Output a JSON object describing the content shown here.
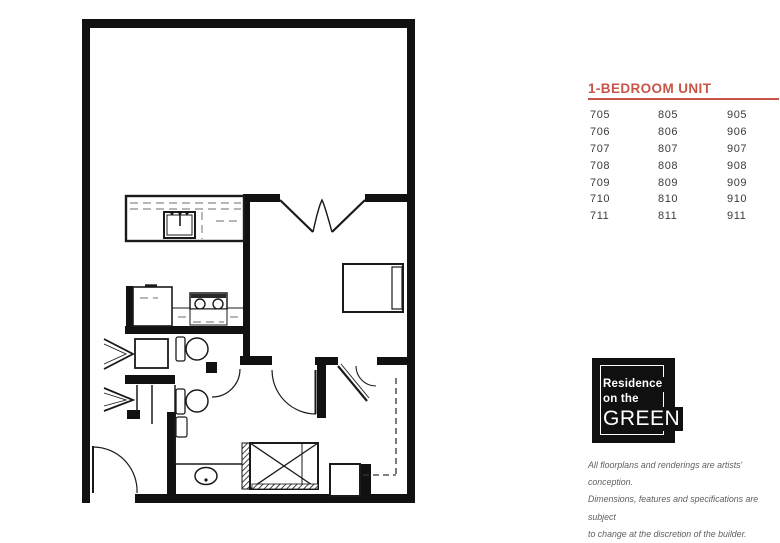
{
  "colors": {
    "accent_red": "#c75547",
    "text_dark": "#3b3b3c",
    "logo_bg": "#101010",
    "plan_line": "#1a1a1a"
  },
  "unit_list": {
    "title": "1-BEDROOM UNIT",
    "rows": [
      [
        "705",
        "805",
        "905"
      ],
      [
        "706",
        "806",
        "906"
      ],
      [
        "707",
        "807",
        "907"
      ],
      [
        "708",
        "808",
        "908"
      ],
      [
        "709",
        "809",
        "909"
      ],
      [
        "710",
        "810",
        "910"
      ],
      [
        "711",
        "811",
        "911"
      ]
    ]
  },
  "logo": {
    "line1": "Residence",
    "line2": "on the",
    "line3": "GREEN"
  },
  "disclaimer": {
    "line1": "All floorplans and renderings are artists' conception.",
    "line2": "Dimensions, features and specifications are subject",
    "line3": "to change at the discretion of the builder."
  },
  "floor_plan": {
    "label": "1-bedroom unit floor plan"
  }
}
